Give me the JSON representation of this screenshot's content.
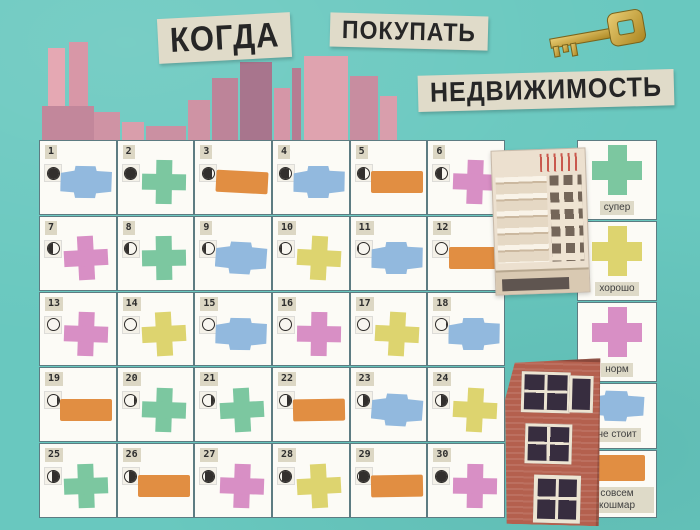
{
  "title": {
    "word1": "КОГДА",
    "word2": "ПОКУПАТЬ",
    "word3": "НЕДВИЖИМОСТЬ"
  },
  "ratings": {
    "super": {
      "label": "супер",
      "shape": "cross",
      "color": "#7cc7a0"
    },
    "horosho": {
      "label": "хорошо",
      "shape": "cross",
      "color": "#ddd46f"
    },
    "norm": {
      "label": "норм",
      "shape": "cross",
      "color": "#d88fc5"
    },
    "ne_stoit": {
      "label": "не стоит",
      "shape": "blob",
      "color": "#92b9de"
    },
    "koshmar": {
      "label": "совсем кошмар",
      "shape": "rect",
      "color": "#e18e42"
    }
  },
  "legend_order": [
    "super",
    "horosho",
    "norm",
    "ne_stoit",
    "koshmar"
  ],
  "icons": [
    "key-icon",
    "moon-phase-icon",
    "city-skyline",
    "apartment-building-photo",
    "brick-house-photo"
  ],
  "colors": {
    "background": "#69c8bf",
    "card": "#fcfbf6",
    "paper_strip": "#e0dbc9",
    "ink": "#262626",
    "grid_line": "#5d7c82",
    "moon_dark": "#322f2d",
    "skyline_pink": "#d99cab",
    "brick": "#b4604e",
    "key_gold": "#c9a437"
  },
  "calendar": {
    "days": [
      {
        "day": 1,
        "moon": {
          "dark_pct": 100,
          "dark_side": "left"
        },
        "rating": "ne_stoit"
      },
      {
        "day": 2,
        "moon": {
          "dark_pct": 100,
          "dark_side": "left"
        },
        "rating": "super"
      },
      {
        "day": 3,
        "moon": {
          "dark_pct": 85,
          "dark_side": "left"
        },
        "rating": "koshmar"
      },
      {
        "day": 4,
        "moon": {
          "dark_pct": 75,
          "dark_side": "left"
        },
        "rating": "ne_stoit"
      },
      {
        "day": 5,
        "moon": {
          "dark_pct": 62,
          "dark_side": "left"
        },
        "rating": "koshmar"
      },
      {
        "day": 6,
        "moon": {
          "dark_pct": 52,
          "dark_side": "left"
        },
        "rating": "norm"
      },
      {
        "day": 7,
        "moon": {
          "dark_pct": 46,
          "dark_side": "left"
        },
        "rating": "norm"
      },
      {
        "day": 8,
        "moon": {
          "dark_pct": 34,
          "dark_side": "left"
        },
        "rating": "super"
      },
      {
        "day": 9,
        "moon": {
          "dark_pct": 25,
          "dark_side": "left"
        },
        "rating": "ne_stoit"
      },
      {
        "day": 10,
        "moon": {
          "dark_pct": 18,
          "dark_side": "left"
        },
        "rating": "horosho"
      },
      {
        "day": 11,
        "moon": {
          "dark_pct": 10,
          "dark_side": "left"
        },
        "rating": "ne_stoit"
      },
      {
        "day": 12,
        "moon": {
          "dark_pct": 0,
          "dark_side": "left"
        },
        "rating": "koshmar"
      },
      {
        "day": 13,
        "moon": {
          "dark_pct": 0,
          "dark_side": "left"
        },
        "rating": "norm"
      },
      {
        "day": 14,
        "moon": {
          "dark_pct": 0,
          "dark_side": "left"
        },
        "rating": "horosho"
      },
      {
        "day": 15,
        "moon": {
          "dark_pct": 0,
          "dark_side": "left"
        },
        "rating": "ne_stoit"
      },
      {
        "day": 16,
        "moon": {
          "dark_pct": 0,
          "dark_side": "left"
        },
        "rating": "norm"
      },
      {
        "day": 17,
        "moon": {
          "dark_pct": 0,
          "dark_side": "left"
        },
        "rating": "horosho"
      },
      {
        "day": 18,
        "moon": {
          "dark_pct": 8,
          "dark_side": "right"
        },
        "rating": "ne_stoit"
      },
      {
        "day": 19,
        "moon": {
          "dark_pct": 14,
          "dark_side": "right"
        },
        "rating": "koshmar"
      },
      {
        "day": 20,
        "moon": {
          "dark_pct": 20,
          "dark_side": "right"
        },
        "rating": "super"
      },
      {
        "day": 21,
        "moon": {
          "dark_pct": 30,
          "dark_side": "right"
        },
        "rating": "super"
      },
      {
        "day": 22,
        "moon": {
          "dark_pct": 42,
          "dark_side": "right"
        },
        "rating": "koshmar"
      },
      {
        "day": 23,
        "moon": {
          "dark_pct": 52,
          "dark_side": "right"
        },
        "rating": "ne_stoit"
      },
      {
        "day": 24,
        "moon": {
          "dark_pct": 55,
          "dark_side": "right"
        },
        "rating": "horosho"
      },
      {
        "day": 25,
        "moon": {
          "dark_pct": 58,
          "dark_side": "right"
        },
        "rating": "super"
      },
      {
        "day": 26,
        "moon": {
          "dark_pct": 68,
          "dark_side": "right"
        },
        "rating": "koshmar"
      },
      {
        "day": 27,
        "moon": {
          "dark_pct": 76,
          "dark_side": "right"
        },
        "rating": "norm"
      },
      {
        "day": 28,
        "moon": {
          "dark_pct": 84,
          "dark_side": "right"
        },
        "rating": "horosho"
      },
      {
        "day": 29,
        "moon": {
          "dark_pct": 93,
          "dark_side": "right"
        },
        "rating": "koshmar"
      },
      {
        "day": 30,
        "moon": {
          "dark_pct": 100,
          "dark_side": "right"
        },
        "rating": "norm"
      }
    ]
  }
}
